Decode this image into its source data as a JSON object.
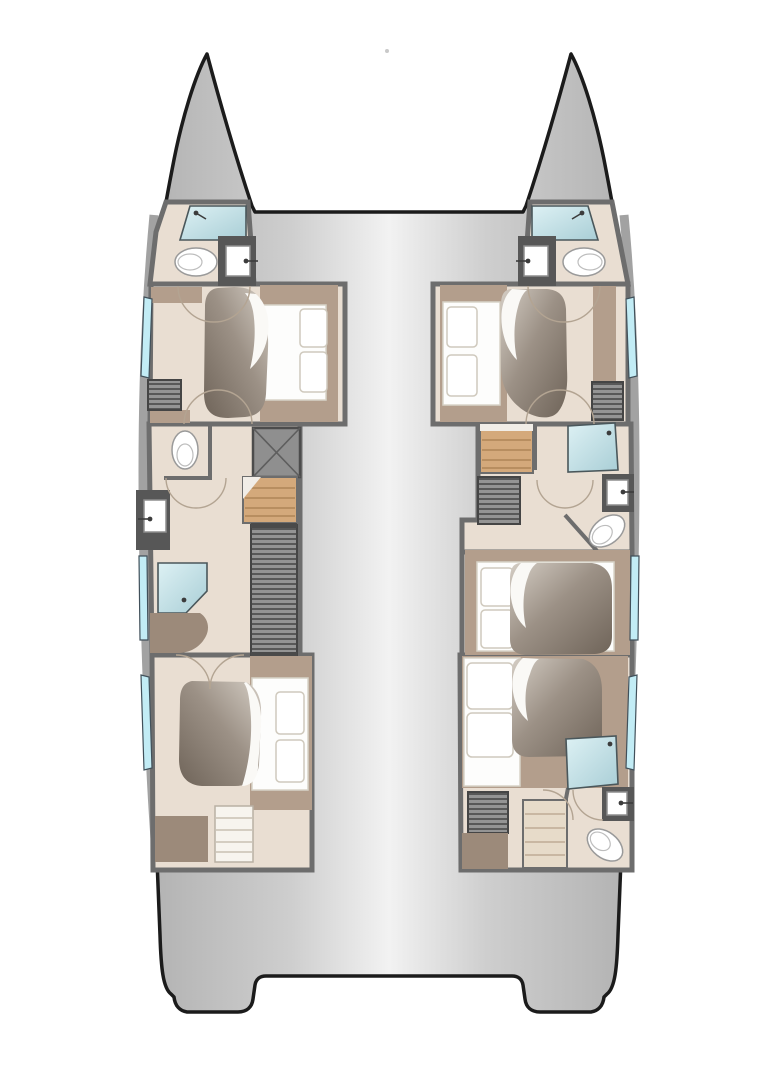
{
  "page": {
    "background": "#ffffff",
    "description": "Top-down deck plan of a sailing catamaran: twin pointed bows at top, two hulls with cabins and bathrooms joined by an open bridge deck, twin transoms with a central recess at the stern"
  },
  "palette": {
    "background": "#ffffff",
    "outline": "#1b1b1b",
    "hullEdge": "#b1b1b1",
    "hullMid": "#cecece",
    "hullCenter": "#f2f2f2",
    "wall": "#6d6d6d",
    "wallBand": "#a2a2a2",
    "floor": "#e9ded2",
    "showerLight": "#ddf1f4",
    "showerDark": "#a9ced6",
    "window": "#c2ecf5",
    "wood": "#d4a97b",
    "woodLine": "#b88e60",
    "stepsLight": "#e7dbc9",
    "stepsLine": "#c9b7a2",
    "shelf": "#b39e8c",
    "furnBrown": "#9c8a7a",
    "duvetDark": "#6f6459",
    "duvetMid": "#9c9186",
    "duvetLight": "#d4cdc4",
    "bedWhite": "#fdfdfc",
    "counter": "#575757",
    "hatchBg": "#949494",
    "hatchLine": "#585858",
    "doorArc": "#b3a492",
    "porcelain": "#ffffff",
    "fixture": "#3c3c3c",
    "xboxFill": "#8f8f8f"
  },
  "diagram": {
    "type": "floorplan",
    "subject": "catamaran yacht accommodation deck plan",
    "view": "top-down, bows at top, stern at bottom",
    "port_hull": {
      "position": "left",
      "rooms": [
        {
          "name": "bow head",
          "fixtures": [
            "shower",
            "toilet",
            "washbasin"
          ]
        },
        {
          "name": "forward double cabin",
          "fixtures": [
            "island double berth",
            "two pillows",
            "duvet",
            "louvered wardrobe",
            "shelves"
          ]
        },
        {
          "name": "midship head",
          "fixtures": [
            "separate WC",
            "washbasin",
            "shower",
            "bench"
          ]
        },
        {
          "name": "companionway",
          "fixtures": [
            "wood stairs",
            "technical locker marked X",
            "long louvered locker"
          ]
        },
        {
          "name": "aft double cabin",
          "fixtures": [
            "island double berth",
            "two pillows",
            "duvet",
            "dresser",
            "cabinet"
          ]
        }
      ]
    },
    "starboard_hull": {
      "position": "right",
      "rooms": [
        {
          "name": "bow head",
          "fixtures": [
            "shower",
            "toilet",
            "washbasin"
          ]
        },
        {
          "name": "forward double cabin",
          "fixtures": [
            "island double berth",
            "two pillows",
            "duvet",
            "louvered wardrobe",
            "shelves"
          ]
        },
        {
          "name": "companionway",
          "fixtures": [
            "wood stairs",
            "louvered locker"
          ]
        },
        {
          "name": "midship head",
          "fixtures": [
            "shower",
            "washbasin",
            "WC"
          ]
        },
        {
          "name": "mid double cabin",
          "fixtures": [
            "double berth",
            "two pillows",
            "duvet",
            "shelves"
          ]
        },
        {
          "name": "aft double cabin with ensuite",
          "fixtures": [
            "double berth",
            "two pillows",
            "duvet",
            "shower",
            "washbasin",
            "WC",
            "louvered wardrobe",
            "steps"
          ]
        }
      ]
    },
    "shared": {
      "bow_area": "open gap between the two bows (trampoline area, white)",
      "bridge_deck": "plain gray deck between the hulls",
      "stern": "twin transom platforms with central recess"
    },
    "counts": {
      "double_berths": 5,
      "heads": 5,
      "showers": 5,
      "toilets": 5,
      "washbasins": 5,
      "staircases": 3,
      "lockers": 5,
      "hull_windows": 6
    }
  }
}
